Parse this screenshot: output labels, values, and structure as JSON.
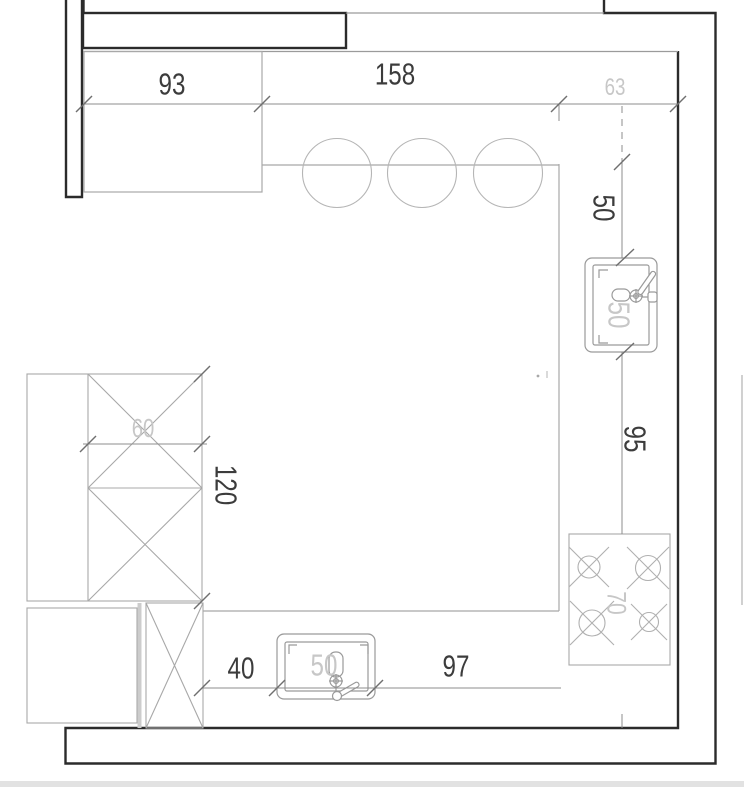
{
  "drawing": {
    "title": "kitchen-floor-plan",
    "dimensions": {
      "top_cabinet_width": "93",
      "top_counter_width": "158",
      "top_right_offset": "63",
      "right_sink_offset": "50",
      "right_sink_to_stove": "95",
      "left_cabinet_depth": "60",
      "left_cabinet_height": "120",
      "bottom_left_offset": "40",
      "bottom_sink_to_stove": "97"
    },
    "fixtures": {
      "sink_right_size": "50",
      "sink_bottom_size": "50",
      "stove_size": "70",
      "bar_stool_count": 3
    },
    "colors": {
      "wall_line": "#2b2b2b",
      "furniture_line": "#a8a8a8",
      "stool_line": "#b5b5b5",
      "dimension_line": "#8d8d8d",
      "dimension_text": "#3c3c3c",
      "light_text": "#c7c7c7",
      "footer_band": "#e2e2e2"
    }
  }
}
